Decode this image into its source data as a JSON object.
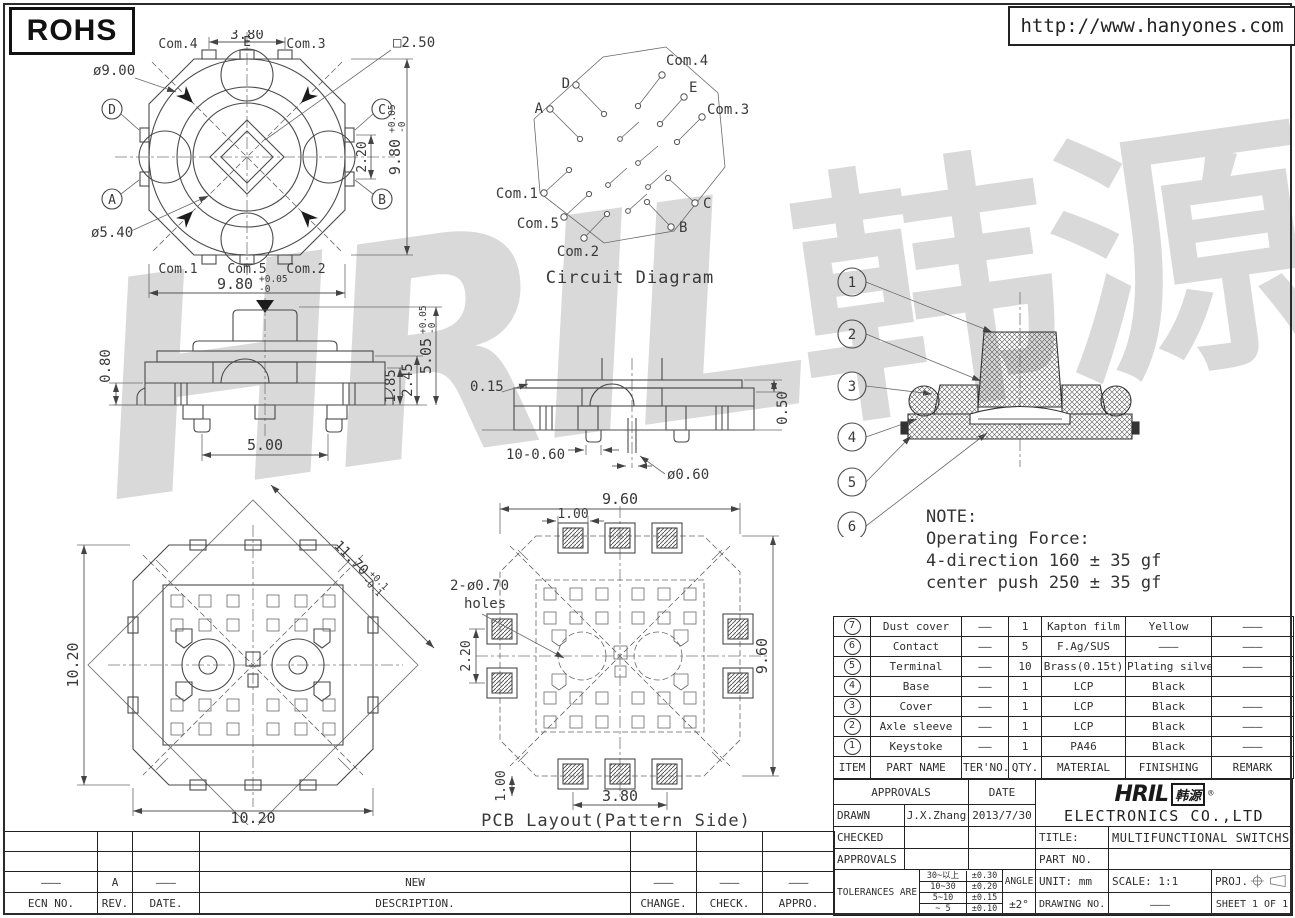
{
  "header": {
    "rohs": "ROHS",
    "url": "http://www.hanyones.com"
  },
  "watermark": {
    "latin": "HRIL",
    "cjk": "韩源"
  },
  "top_view": {
    "dim_terminal_pitch": "3.80",
    "dim_square": "□2.50",
    "dim_outer_dia": "ø9.00",
    "dim_inner_dia": "ø5.40",
    "dim_side_tab_pitch": "2.20",
    "dim_width": "9.80",
    "dim_width_tol_plus": "+0.05",
    "dim_width_tol_minus": "-0",
    "dim_height": "9.80",
    "dim_height_tol_plus": "+0.05",
    "dim_height_tol_minus": "-0",
    "terminals_top": [
      "Com.4",
      "E",
      "Com.3"
    ],
    "terminals_bottom": [
      "Com.1",
      "Com.5",
      "Com.2"
    ],
    "contacts_left": [
      "D",
      "A"
    ],
    "contacts_right": [
      "C",
      "B"
    ]
  },
  "circuit": {
    "caption": "Circuit Diagram",
    "labels": {
      "com4": "Com.4",
      "e": "E",
      "com3": "Com.3",
      "c": "C",
      "b": "B",
      "com2": "Com.2",
      "com5": "Com.5",
      "com1": "Com.1",
      "a": "A",
      "d": "D"
    }
  },
  "front_view": {
    "dim_base": "0.80",
    "dim_body": "1.85",
    "dim_mid": "2.45",
    "dim_total": "5.05",
    "dim_total_tol_plus": "+0.05",
    "dim_total_tol_minus": "-0",
    "dim_leg_span": "5.00"
  },
  "side_view": {
    "dim_cover": "0.15",
    "dim_legs": "10-0.60",
    "dim_leg_dia": "ø0.60",
    "dim_step": "0.50"
  },
  "section_view": {
    "callouts": [
      "1",
      "2",
      "3",
      "4",
      "5",
      "6"
    ]
  },
  "note": {
    "line1": "NOTE:",
    "line2": "Operating Force:",
    "line3": "4-direction 160 ± 35 gf",
    "line4": "center push 250 ± 35 gf"
  },
  "bottom_view": {
    "dim_height": "10.20",
    "dim_width": "10.20",
    "dim_diag": "11.70",
    "dim_diag_tol_plus": "+0.1",
    "dim_diag_tol_minus": "-0.1"
  },
  "pcb": {
    "caption": "PCB Layout(Pattern Side)",
    "dim_width": "9.60",
    "dim_height": "9.60",
    "dim_pad": "1.00",
    "dim_pad_offset": "1.00",
    "dim_side_pitch": "2.20",
    "dim_span": "3.80",
    "holes_label1": "2-ø0.70",
    "holes_label2": "holes"
  },
  "parts_table": {
    "headers": [
      "ITEM",
      "PART NAME",
      "TER'NO.",
      "QTY.",
      "MATERIAL",
      "FINISHING",
      "REMARK"
    ],
    "rows": [
      {
        "item": "7",
        "name": "Dust cover",
        "ter": "——",
        "qty": "1",
        "material": "Kapton film",
        "finishing": "Yellow",
        "remark": "———"
      },
      {
        "item": "6",
        "name": "Contact",
        "ter": "——",
        "qty": "5",
        "material": "F.Ag/SUS",
        "finishing": "———",
        "remark": "———"
      },
      {
        "item": "5",
        "name": "Terminal",
        "ter": "——",
        "qty": "10",
        "material": "Brass(0.15t)",
        "finishing": "Plating silver",
        "remark": "———"
      },
      {
        "item": "4",
        "name": "Base",
        "ter": "——",
        "qty": "1",
        "material": "LCP",
        "finishing": "Black",
        "remark": ""
      },
      {
        "item": "3",
        "name": "Cover",
        "ter": "——",
        "qty": "1",
        "material": "LCP",
        "finishing": "Black",
        "remark": "———"
      },
      {
        "item": "2",
        "name": "Axle sleeve",
        "ter": "——",
        "qty": "1",
        "material": "LCP",
        "finishing": "Black",
        "remark": "———"
      },
      {
        "item": "1",
        "name": "Keystoke",
        "ter": "——",
        "qty": "1",
        "material": "PA46",
        "finishing": "Black",
        "remark": "———"
      }
    ]
  },
  "title_block": {
    "approvals": "APPROVALS",
    "date": "DATE",
    "drawn": "DRAWN",
    "drawn_by": "J.X.Zhang",
    "drawn_date": "2013/7/30",
    "checked": "CHECKED",
    "approvals2": "APPROVALS",
    "tolerances": "TOLERANCES ARE",
    "tol_rows": [
      {
        "range": "30~以上",
        "tol": "±0.30"
      },
      {
        "range": "10~30",
        "tol": "±0.20"
      },
      {
        "range": "5~10",
        "tol": "±0.15"
      },
      {
        "range": "~ 5",
        "tol": "±0.10"
      }
    ],
    "angle": "ANGLE",
    "angle_val": "±2°",
    "logo_latin": "HRIL",
    "logo_cn": "韩源",
    "logo_reg": "®",
    "company": "ELECTRONICS CO.,LTD",
    "title_label": "TITLE:",
    "title_value": "MULTIFUNCTIONAL SWITCHS",
    "part_no_label": "PART NO.",
    "unit": "UNIT: mm",
    "scale": "SCALE: 1:1",
    "proj": "PROJ.",
    "drawing_no_label": "DRAWING NO.",
    "drawing_no_value": "———",
    "sheet": "SHEET 1 OF 1"
  },
  "revision_table": {
    "headers": [
      "ECN NO.",
      "REV.",
      "DATE.",
      "DESCRIPTION.",
      "CHANGE.",
      "CHECK.",
      "APPRO."
    ],
    "row": [
      "———",
      "A",
      "———",
      "NEW",
      "———",
      "———",
      "———"
    ]
  }
}
